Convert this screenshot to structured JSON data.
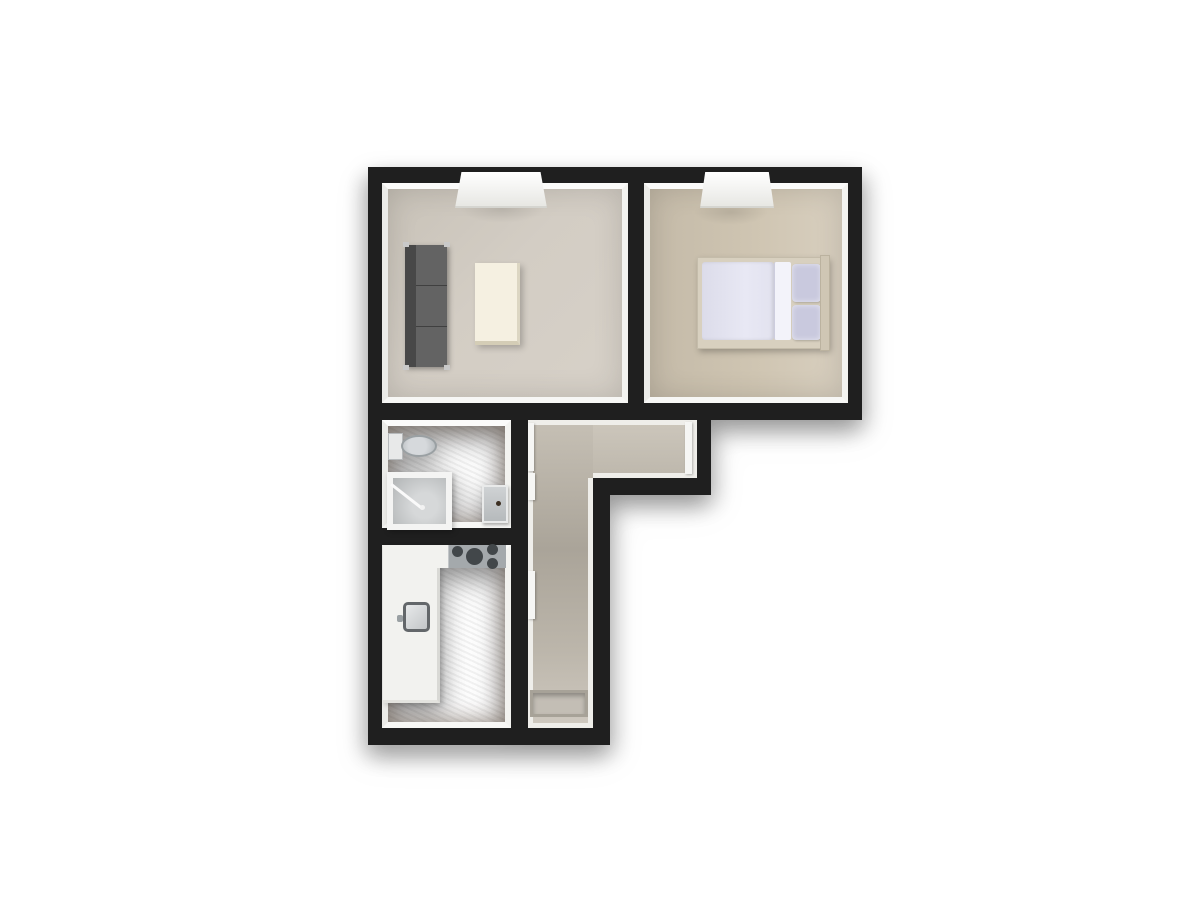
{
  "scene": {
    "description": "3D top-down floor plan render of a small apartment",
    "background_color": "#ffffff",
    "wall_color": "#1f1f1f",
    "wall_face_color": "#efeeea"
  },
  "rooms": {
    "living": {
      "label": "living-room",
      "floor_color": "#d3cdc4",
      "items": [
        "window",
        "sofa",
        "coffee-table",
        "ceiling-light"
      ]
    },
    "bedroom": {
      "label": "bedroom",
      "floor_color": "#cfc5b2",
      "items": [
        "window",
        "double-bed",
        "duvet",
        "pillows",
        "headboard",
        "ceiling-light"
      ]
    },
    "bathroom": {
      "label": "bathroom",
      "floor_color": "#b2661f",
      "items": [
        "toilet",
        "shower",
        "washbasin"
      ]
    },
    "kitchen": {
      "label": "kitchen",
      "floor_color": "#b2661f",
      "items": [
        "counter",
        "cooktop",
        "sink",
        "faucet"
      ]
    },
    "hallway": {
      "label": "hallway",
      "floor_color": "#c2bcb1",
      "items": [
        "doormat",
        "door-living",
        "door-bathroom",
        "door-kitchen",
        "door-bedroom"
      ]
    }
  },
  "furniture_colors": {
    "sofa": "#636363",
    "sofa_back": "#484848",
    "coffee_table": "#f5f0e1",
    "bed_frame": "#d8d0bf",
    "duvet": "#e6e6f3",
    "pillow": "#c9c9de",
    "toilet": "#d6d9dc",
    "shower_tray": "#c3c5c6",
    "washbasin": "#c4c8ca",
    "counter": "#f2f2ef",
    "cooktop": "#a4a9ac",
    "burner": "#42474a",
    "doormat": "#c3beb5",
    "door_panel": "#f6f6f4"
  }
}
